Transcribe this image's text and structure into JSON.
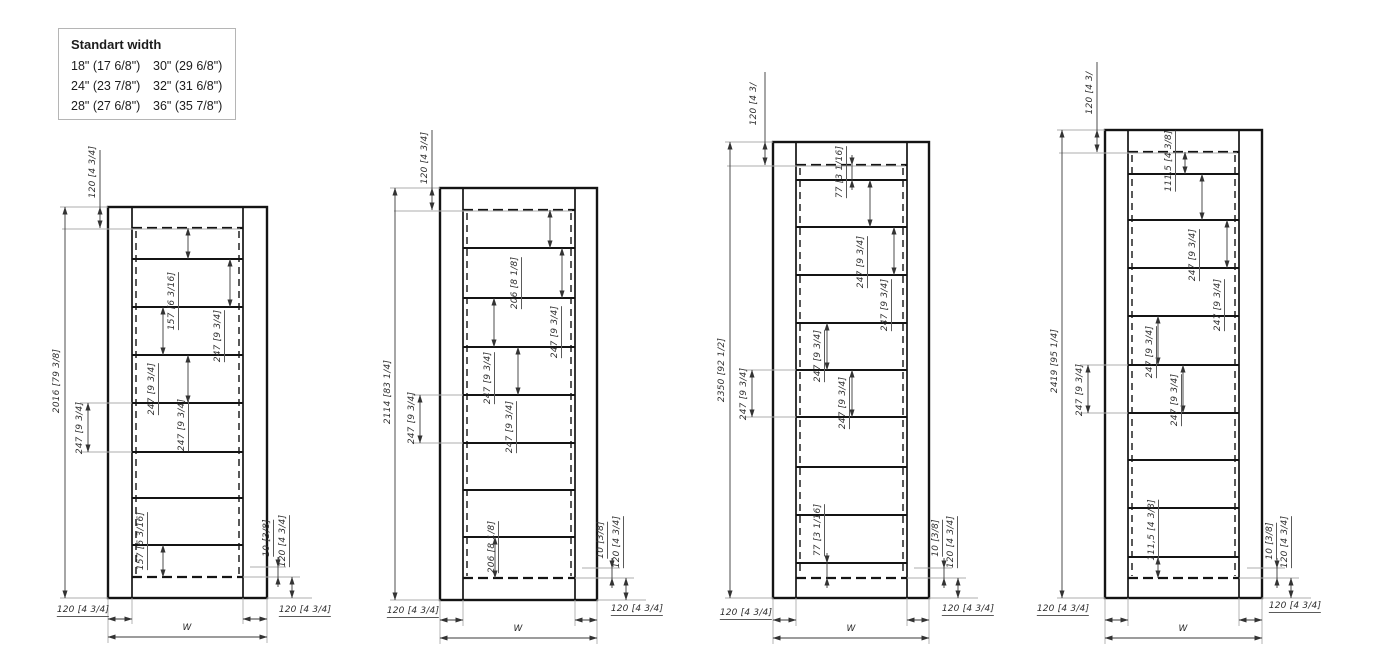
{
  "legend": {
    "title": "Standart width",
    "rows": [
      [
        "18\" (17 6/8\")",
        "30\" (29 6/8\")"
      ],
      [
        "24\" (23 7/8\")",
        "32\" (31 6/8\")"
      ],
      [
        "28\" (27 6/8\")",
        "36\" (35 7/8\")"
      ]
    ]
  },
  "drawings": [
    {
      "name": "cabinet-elevation-2016",
      "frame": {
        "l": 108,
        "r": 267,
        "t": 207,
        "b": 598,
        "il": 132,
        "ir": 243,
        "dt": 228,
        "db": 577
      },
      "shelves": [
        259,
        307,
        355,
        403,
        452,
        498,
        545
      ],
      "vdims": [
        {
          "x": 100,
          "y1": 207,
          "y2": 228,
          "tail": 150
        },
        {
          "x": 65,
          "y1": 207,
          "y2": 598
        },
        {
          "x": 88,
          "y1": 403,
          "y2": 452
        },
        {
          "x": 188,
          "y1": 228,
          "y2": 259
        },
        {
          "x": 230,
          "y1": 259,
          "y2": 307
        },
        {
          "x": 163,
          "y1": 307,
          "y2": 355
        },
        {
          "x": 188,
          "y1": 355,
          "y2": 403
        },
        {
          "x": 163,
          "y1": 545,
          "y2": 577
        },
        {
          "x": 278,
          "y1": 567,
          "y2": 577
        },
        {
          "x": 292,
          "y1": 577,
          "y2": 598
        }
      ],
      "hdims": [
        {
          "y": 619,
          "x1": 108,
          "x2": 132
        },
        {
          "y": 619,
          "x1": 243,
          "x2": 267
        },
        {
          "y": 637,
          "x1": 108,
          "x2": 267
        }
      ],
      "ext": [
        [
          60,
          207,
          108,
          207
        ],
        [
          60,
          598,
          108,
          598
        ],
        [
          62,
          229,
          240,
          229
        ],
        [
          80,
          403,
          132,
          403
        ],
        [
          80,
          452,
          132,
          452
        ],
        [
          250,
          567,
          286,
          567
        ],
        [
          243,
          577,
          300,
          577
        ],
        [
          267,
          598,
          312,
          598
        ],
        [
          108,
          598,
          108,
          643
        ],
        [
          132,
          598,
          132,
          624
        ],
        [
          243,
          598,
          243,
          624
        ],
        [
          267,
          598,
          267,
          643
        ]
      ],
      "labels": [
        {
          "t": "120 [4 3/4]",
          "x": 93,
          "y": 172,
          "r": 1
        },
        {
          "t": "2016 [79 3/8]",
          "x": 57,
          "y": 381,
          "r": 1
        },
        {
          "t": "247 [9 3/4]",
          "x": 80,
          "y": 428,
          "r": 1
        },
        {
          "t": "157 [6 3/16]",
          "x": 173,
          "y": 301,
          "r": 1,
          "u": 1
        },
        {
          "t": "247 [9 3/4]",
          "x": 219,
          "y": 336,
          "r": 1,
          "u": 1
        },
        {
          "t": "247 [9 3/4]",
          "x": 153,
          "y": 389,
          "r": 1,
          "u": 1
        },
        {
          "t": "247 [9 3/4]",
          "x": 183,
          "y": 425,
          "r": 1,
          "u": 1
        },
        {
          "t": "157 [6 3/16]",
          "x": 142,
          "y": 541,
          "r": 1,
          "u": 1
        },
        {
          "t": "10 [3/8]",
          "x": 268,
          "y": 538,
          "r": 1,
          "u": 1
        },
        {
          "t": "120 [4 3/4]",
          "x": 284,
          "y": 541,
          "r": 1,
          "u": 1
        },
        {
          "t": "120 [4 3/4]",
          "x": 83,
          "y": 611,
          "u": 1
        },
        {
          "t": "W",
          "x": 187,
          "y": 628
        },
        {
          "t": "120 [4 3/4]",
          "x": 305,
          "y": 611,
          "u": 1
        }
      ]
    },
    {
      "name": "cabinet-elevation-2114",
      "frame": {
        "l": 440,
        "r": 597,
        "t": 188,
        "b": 600,
        "il": 463,
        "ir": 575,
        "dt": 210,
        "db": 578
      },
      "shelves": [
        248,
        298,
        347,
        395,
        443,
        490,
        537
      ],
      "vdims": [
        {
          "x": 432,
          "y1": 188,
          "y2": 210,
          "tail": 130
        },
        {
          "x": 395,
          "y1": 188,
          "y2": 600
        },
        {
          "x": 420,
          "y1": 395,
          "y2": 443
        },
        {
          "x": 550,
          "y1": 210,
          "y2": 248
        },
        {
          "x": 562,
          "y1": 248,
          "y2": 298
        },
        {
          "x": 494,
          "y1": 298,
          "y2": 347
        },
        {
          "x": 518,
          "y1": 347,
          "y2": 395
        },
        {
          "x": 495,
          "y1": 537,
          "y2": 578
        },
        {
          "x": 612,
          "y1": 568,
          "y2": 578
        },
        {
          "x": 626,
          "y1": 578,
          "y2": 600
        }
      ],
      "hdims": [
        {
          "y": 620,
          "x1": 440,
          "x2": 463
        },
        {
          "y": 620,
          "x1": 575,
          "x2": 597
        },
        {
          "y": 638,
          "x1": 440,
          "x2": 597
        }
      ],
      "ext": [
        [
          390,
          188,
          440,
          188
        ],
        [
          390,
          600,
          440,
          600
        ],
        [
          394,
          211,
          572,
          211
        ],
        [
          412,
          395,
          463,
          395
        ],
        [
          412,
          443,
          463,
          443
        ],
        [
          582,
          568,
          620,
          568
        ],
        [
          575,
          578,
          634,
          578
        ],
        [
          597,
          600,
          646,
          600
        ],
        [
          440,
          600,
          440,
          644
        ],
        [
          463,
          600,
          463,
          626
        ],
        [
          575,
          600,
          575,
          626
        ],
        [
          597,
          600,
          597,
          644
        ]
      ],
      "labels": [
        {
          "t": "120 [4 3/4]",
          "x": 425,
          "y": 158,
          "r": 1
        },
        {
          "t": "2114 [83 1/4]",
          "x": 388,
          "y": 392,
          "r": 1
        },
        {
          "t": "247 [9 3/4]",
          "x": 412,
          "y": 418,
          "r": 1
        },
        {
          "t": "206 [8 1/8]",
          "x": 516,
          "y": 283,
          "r": 1,
          "u": 1
        },
        {
          "t": "247 [9 3/4]",
          "x": 556,
          "y": 332,
          "r": 1,
          "u": 1
        },
        {
          "t": "247 [9 3/4]",
          "x": 489,
          "y": 378,
          "r": 1,
          "u": 1
        },
        {
          "t": "247 [9 3/4]",
          "x": 511,
          "y": 427,
          "r": 1,
          "u": 1
        },
        {
          "t": "206 [8 1/8]",
          "x": 493,
          "y": 547,
          "r": 1,
          "u": 1
        },
        {
          "t": "10 [3/8]",
          "x": 602,
          "y": 540,
          "r": 1,
          "u": 1
        },
        {
          "t": "120 [4 3/4]",
          "x": 618,
          "y": 542,
          "r": 1,
          "u": 1
        },
        {
          "t": "120 [4 3/4]",
          "x": 413,
          "y": 612,
          "u": 1
        },
        {
          "t": "W",
          "x": 518,
          "y": 629
        },
        {
          "t": "120 [4 3/4]",
          "x": 637,
          "y": 610,
          "u": 1
        }
      ]
    },
    {
      "name": "cabinet-elevation-2350",
      "frame": {
        "l": 773,
        "r": 929,
        "t": 142,
        "b": 598,
        "il": 796,
        "ir": 907,
        "dt": 165,
        "db": 578
      },
      "shelves": [
        180,
        227,
        275,
        323,
        370,
        417,
        467,
        515,
        563
      ],
      "vdims": [
        {
          "x": 765,
          "y1": 142,
          "y2": 165,
          "tail": 72
        },
        {
          "x": 730,
          "y1": 142,
          "y2": 598
        },
        {
          "x": 752,
          "y1": 370,
          "y2": 417
        },
        {
          "x": 852,
          "y1": 165,
          "y2": 180
        },
        {
          "x": 870,
          "y1": 180,
          "y2": 227
        },
        {
          "x": 894,
          "y1": 227,
          "y2": 275
        },
        {
          "x": 827,
          "y1": 323,
          "y2": 370
        },
        {
          "x": 852,
          "y1": 370,
          "y2": 417
        },
        {
          "x": 827,
          "y1": 563,
          "y2": 578
        },
        {
          "x": 944,
          "y1": 568,
          "y2": 578
        },
        {
          "x": 958,
          "y1": 578,
          "y2": 598
        }
      ],
      "hdims": [
        {
          "y": 620,
          "x1": 773,
          "x2": 796
        },
        {
          "y": 620,
          "x1": 907,
          "x2": 929
        },
        {
          "y": 638,
          "x1": 773,
          "x2": 929
        }
      ],
      "ext": [
        [
          725,
          142,
          773,
          142
        ],
        [
          725,
          598,
          773,
          598
        ],
        [
          727,
          166,
          905,
          166
        ],
        [
          744,
          370,
          796,
          370
        ],
        [
          744,
          417,
          796,
          417
        ],
        [
          914,
          568,
          952,
          568
        ],
        [
          907,
          578,
          966,
          578
        ],
        [
          929,
          598,
          978,
          598
        ],
        [
          773,
          598,
          773,
          644
        ],
        [
          796,
          598,
          796,
          626
        ],
        [
          907,
          598,
          907,
          626
        ],
        [
          929,
          598,
          929,
          644
        ]
      ],
      "labels": [
        {
          "t": "120 [4 3/",
          "x": 754,
          "y": 104,
          "r": 1
        },
        {
          "t": "2350 [92 1/2]",
          "x": 722,
          "y": 370,
          "r": 1
        },
        {
          "t": "247 [9 3/4]",
          "x": 744,
          "y": 394,
          "r": 1
        },
        {
          "t": "77 [3 1/16]",
          "x": 841,
          "y": 172,
          "r": 1,
          "u": 1
        },
        {
          "t": "247 [9 3/4]",
          "x": 862,
          "y": 262,
          "r": 1,
          "u": 1
        },
        {
          "t": "247 [9 3/4]",
          "x": 886,
          "y": 305,
          "r": 1,
          "u": 1
        },
        {
          "t": "247 [9 3/4]",
          "x": 819,
          "y": 356,
          "r": 1,
          "u": 1
        },
        {
          "t": "247 [9 3/4]",
          "x": 844,
          "y": 403,
          "r": 1,
          "u": 1
        },
        {
          "t": "77 [3 1/16]",
          "x": 819,
          "y": 530,
          "r": 1,
          "u": 1
        },
        {
          "t": "10 [3/8]",
          "x": 937,
          "y": 538,
          "r": 1,
          "u": 1
        },
        {
          "t": "120 [4 3/4]",
          "x": 952,
          "y": 542,
          "r": 1,
          "u": 1
        },
        {
          "t": "120 [4 3/4]",
          "x": 746,
          "y": 614,
          "u": 1
        },
        {
          "t": "W",
          "x": 851,
          "y": 629
        },
        {
          "t": "120 [4 3/4]",
          "x": 968,
          "y": 610,
          "u": 1
        }
      ]
    },
    {
      "name": "cabinet-elevation-2419",
      "frame": {
        "l": 1105,
        "r": 1262,
        "t": 130,
        "b": 598,
        "il": 1128,
        "ir": 1239,
        "dt": 152,
        "db": 578
      },
      "shelves": [
        174,
        220,
        268,
        316,
        365,
        413,
        460,
        508,
        557
      ],
      "vdims": [
        {
          "x": 1097,
          "y1": 130,
          "y2": 152,
          "tail": 62
        },
        {
          "x": 1062,
          "y1": 130,
          "y2": 598
        },
        {
          "x": 1088,
          "y1": 365,
          "y2": 413
        },
        {
          "x": 1185,
          "y1": 152,
          "y2": 174
        },
        {
          "x": 1202,
          "y1": 174,
          "y2": 220
        },
        {
          "x": 1227,
          "y1": 220,
          "y2": 268
        },
        {
          "x": 1158,
          "y1": 316,
          "y2": 365
        },
        {
          "x": 1183,
          "y1": 365,
          "y2": 413
        },
        {
          "x": 1158,
          "y1": 557,
          "y2": 578
        },
        {
          "x": 1277,
          "y1": 568,
          "y2": 578
        },
        {
          "x": 1291,
          "y1": 578,
          "y2": 598
        }
      ],
      "hdims": [
        {
          "y": 620,
          "x1": 1105,
          "x2": 1128
        },
        {
          "y": 620,
          "x1": 1239,
          "x2": 1262
        },
        {
          "y": 638,
          "x1": 1105,
          "x2": 1262
        }
      ],
      "ext": [
        [
          1057,
          130,
          1105,
          130
        ],
        [
          1057,
          598,
          1105,
          598
        ],
        [
          1059,
          153,
          1237,
          153
        ],
        [
          1080,
          365,
          1128,
          365
        ],
        [
          1080,
          413,
          1128,
          413
        ],
        [
          1247,
          568,
          1285,
          568
        ],
        [
          1239,
          578,
          1299,
          578
        ],
        [
          1262,
          598,
          1311,
          598
        ],
        [
          1105,
          598,
          1105,
          644
        ],
        [
          1128,
          598,
          1128,
          626
        ],
        [
          1239,
          598,
          1239,
          626
        ],
        [
          1262,
          598,
          1262,
          644
        ]
      ],
      "labels": [
        {
          "t": "120 [4 3/",
          "x": 1090,
          "y": 93,
          "r": 1
        },
        {
          "t": "2419 [95 1/4]",
          "x": 1055,
          "y": 361,
          "r": 1
        },
        {
          "t": "247 [9 3/4]",
          "x": 1080,
          "y": 390,
          "r": 1
        },
        {
          "t": "111,5 [4 3/8]",
          "x": 1170,
          "y": 161,
          "r": 1,
          "u": 1
        },
        {
          "t": "247 [9 3/4]",
          "x": 1194,
          "y": 255,
          "r": 1,
          "u": 1
        },
        {
          "t": "247 [9 3/4]",
          "x": 1219,
          "y": 305,
          "r": 1,
          "u": 1
        },
        {
          "t": "247 [9 3/4]",
          "x": 1151,
          "y": 352,
          "r": 1,
          "u": 1
        },
        {
          "t": "247 [9 3/4]",
          "x": 1176,
          "y": 400,
          "r": 1,
          "u": 1
        },
        {
          "t": "111,5 [4 3/8]",
          "x": 1153,
          "y": 530,
          "r": 1,
          "u": 1
        },
        {
          "t": "10 [3/8]",
          "x": 1271,
          "y": 541,
          "r": 1,
          "u": 1
        },
        {
          "t": "120 [4 3/4]",
          "x": 1286,
          "y": 542,
          "r": 1,
          "u": 1
        },
        {
          "t": "120 [4 3/4]",
          "x": 1063,
          "y": 610,
          "u": 1
        },
        {
          "t": "W",
          "x": 1183,
          "y": 629
        },
        {
          "t": "120 [4 3/4]",
          "x": 1295,
          "y": 607,
          "u": 1
        }
      ]
    }
  ]
}
